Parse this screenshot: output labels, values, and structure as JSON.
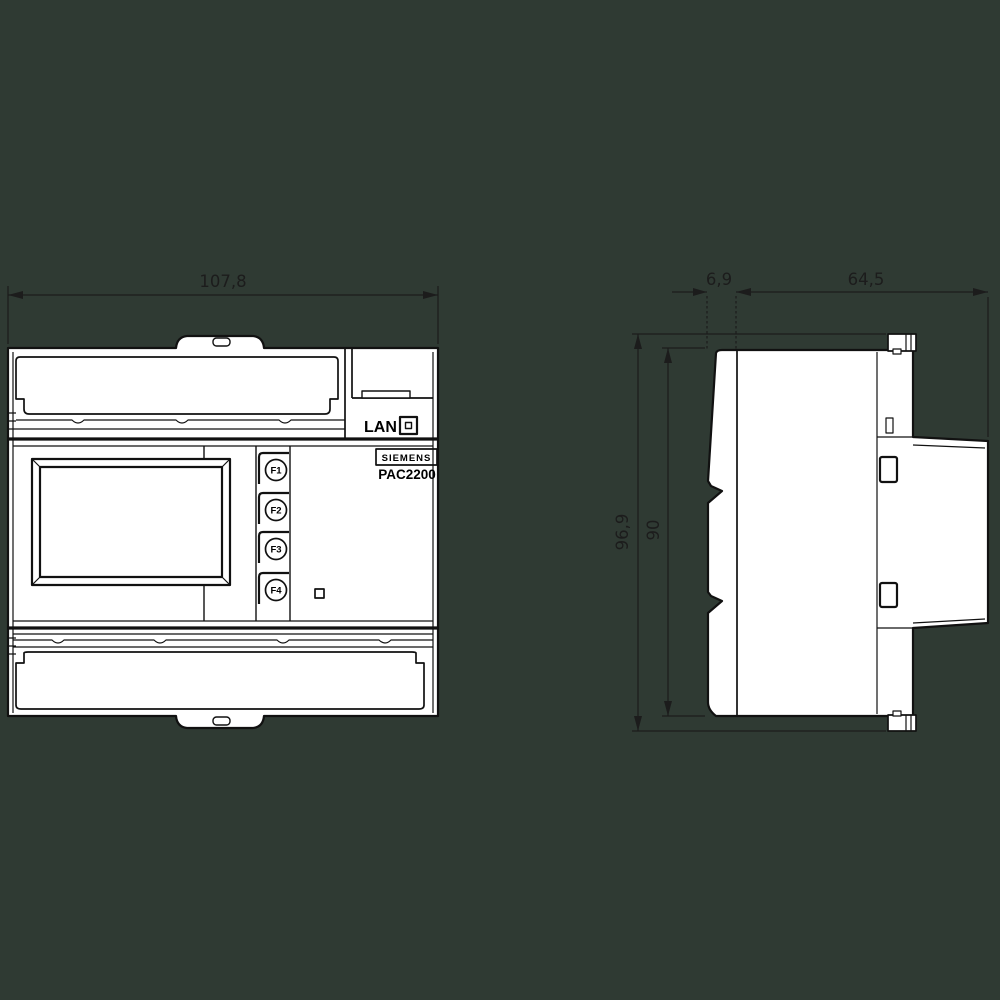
{
  "background_color": "#2f3a33",
  "line_color": "#111111",
  "device_fill": "#ffffff",
  "front_view": {
    "width_dimension": "107,8",
    "lan_label": "LAN",
    "brand": "SIEMENS",
    "model": "PAC2200",
    "function_buttons": [
      "F1",
      "F2",
      "F3",
      "F4"
    ]
  },
  "side_view": {
    "front_depth_dimension": "6,9",
    "body_depth_dimension": "64,5",
    "overall_height_dimension": "96,9",
    "rail_height_dimension": "90"
  }
}
